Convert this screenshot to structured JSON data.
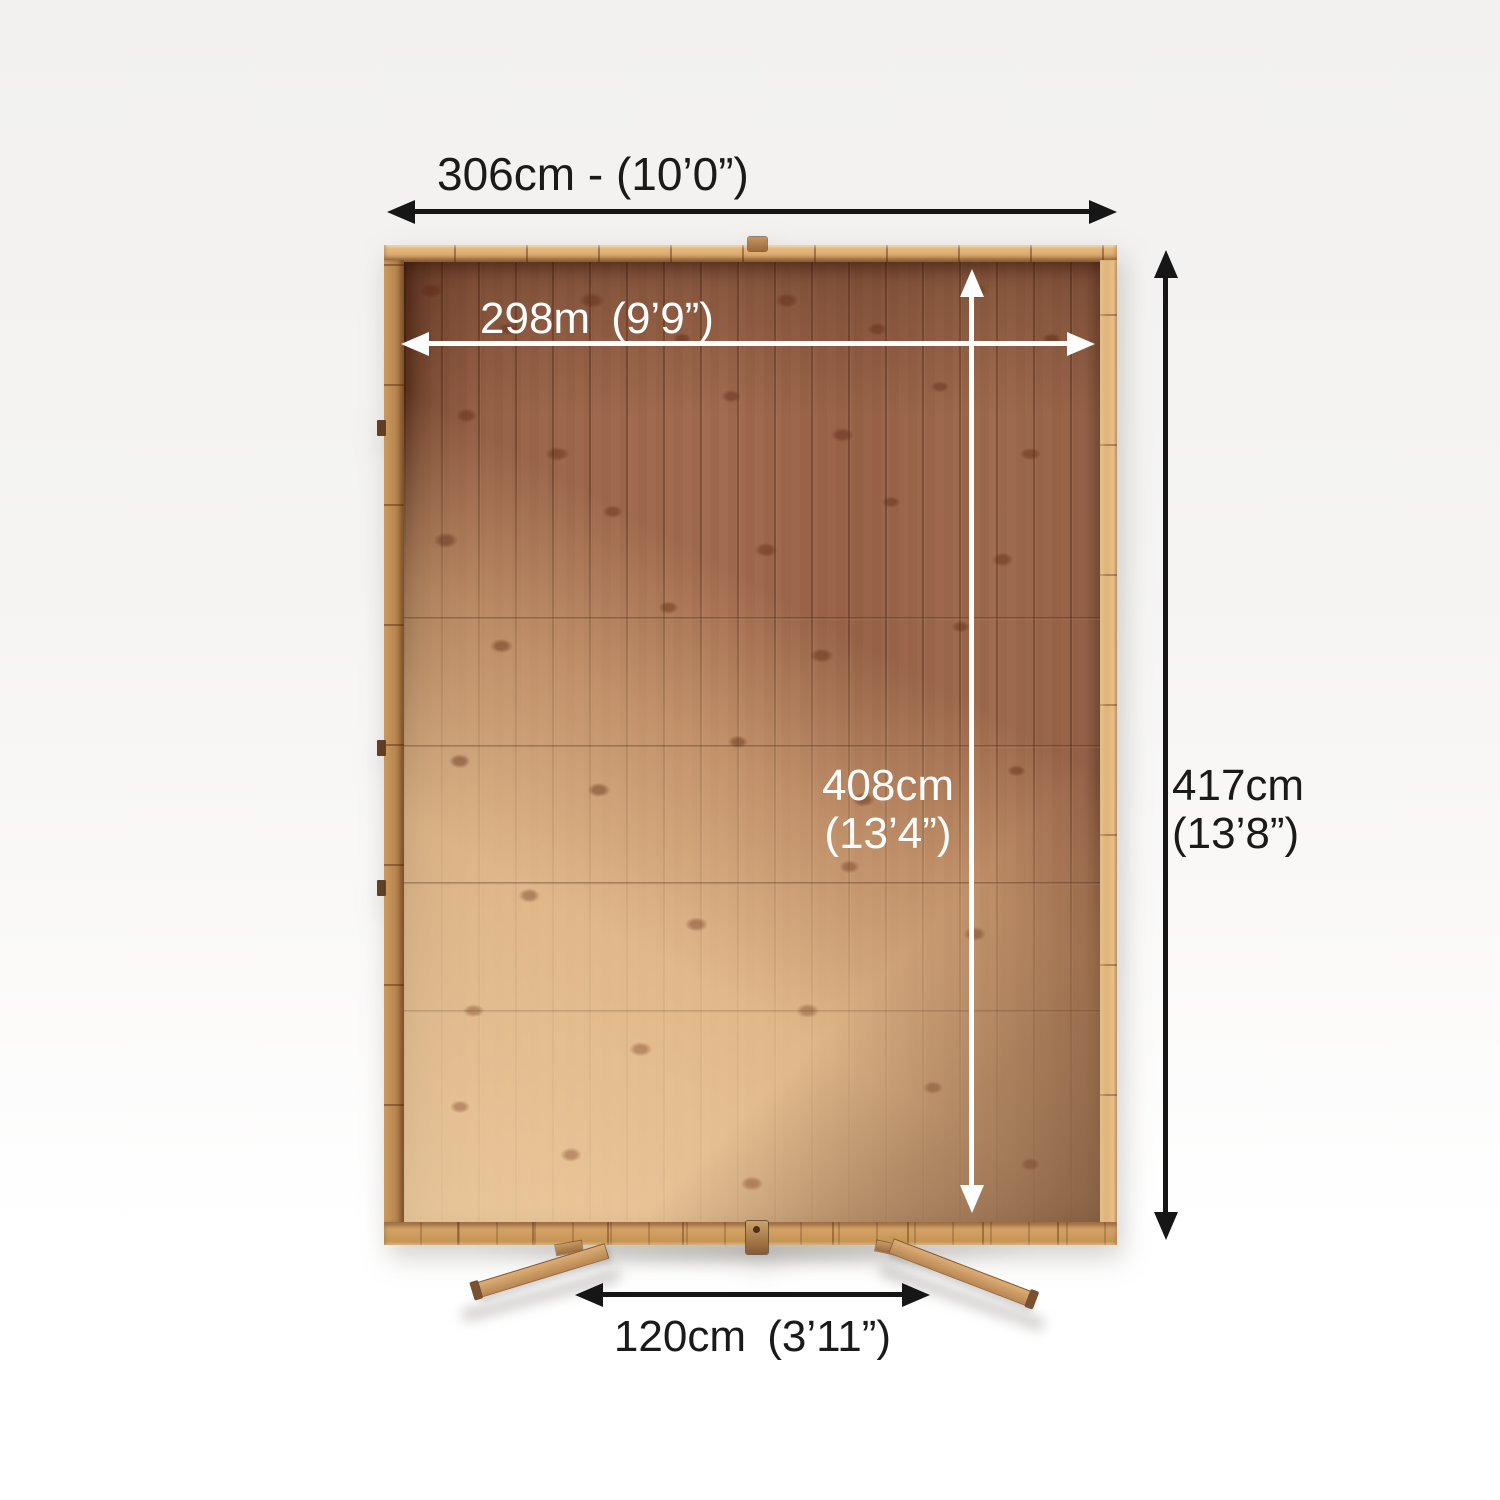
{
  "diagram": {
    "dimensions": {
      "overall_width": {
        "label": "306cm - (10’0”)"
      },
      "internal_width": {
        "label": "298m (9’9”)"
      },
      "internal_depth": {
        "metric": "408cm",
        "imperial": "(13’4”)"
      },
      "overall_depth": {
        "metric": "417cm",
        "imperial": "(13’8”)"
      },
      "door_width": {
        "label": "120cm (3’11”)"
      }
    },
    "colors": {
      "dimension_text_dark": "#1a1a1a",
      "dimension_text_light": "#ffffff",
      "arrow_dark": "#161616",
      "arrow_light": "#ffffff",
      "frame_wood": "#d9a76d",
      "floor_wood": "#9b654a",
      "sunlit_wood": "#e9c294",
      "background": "#f5f4f2"
    }
  }
}
